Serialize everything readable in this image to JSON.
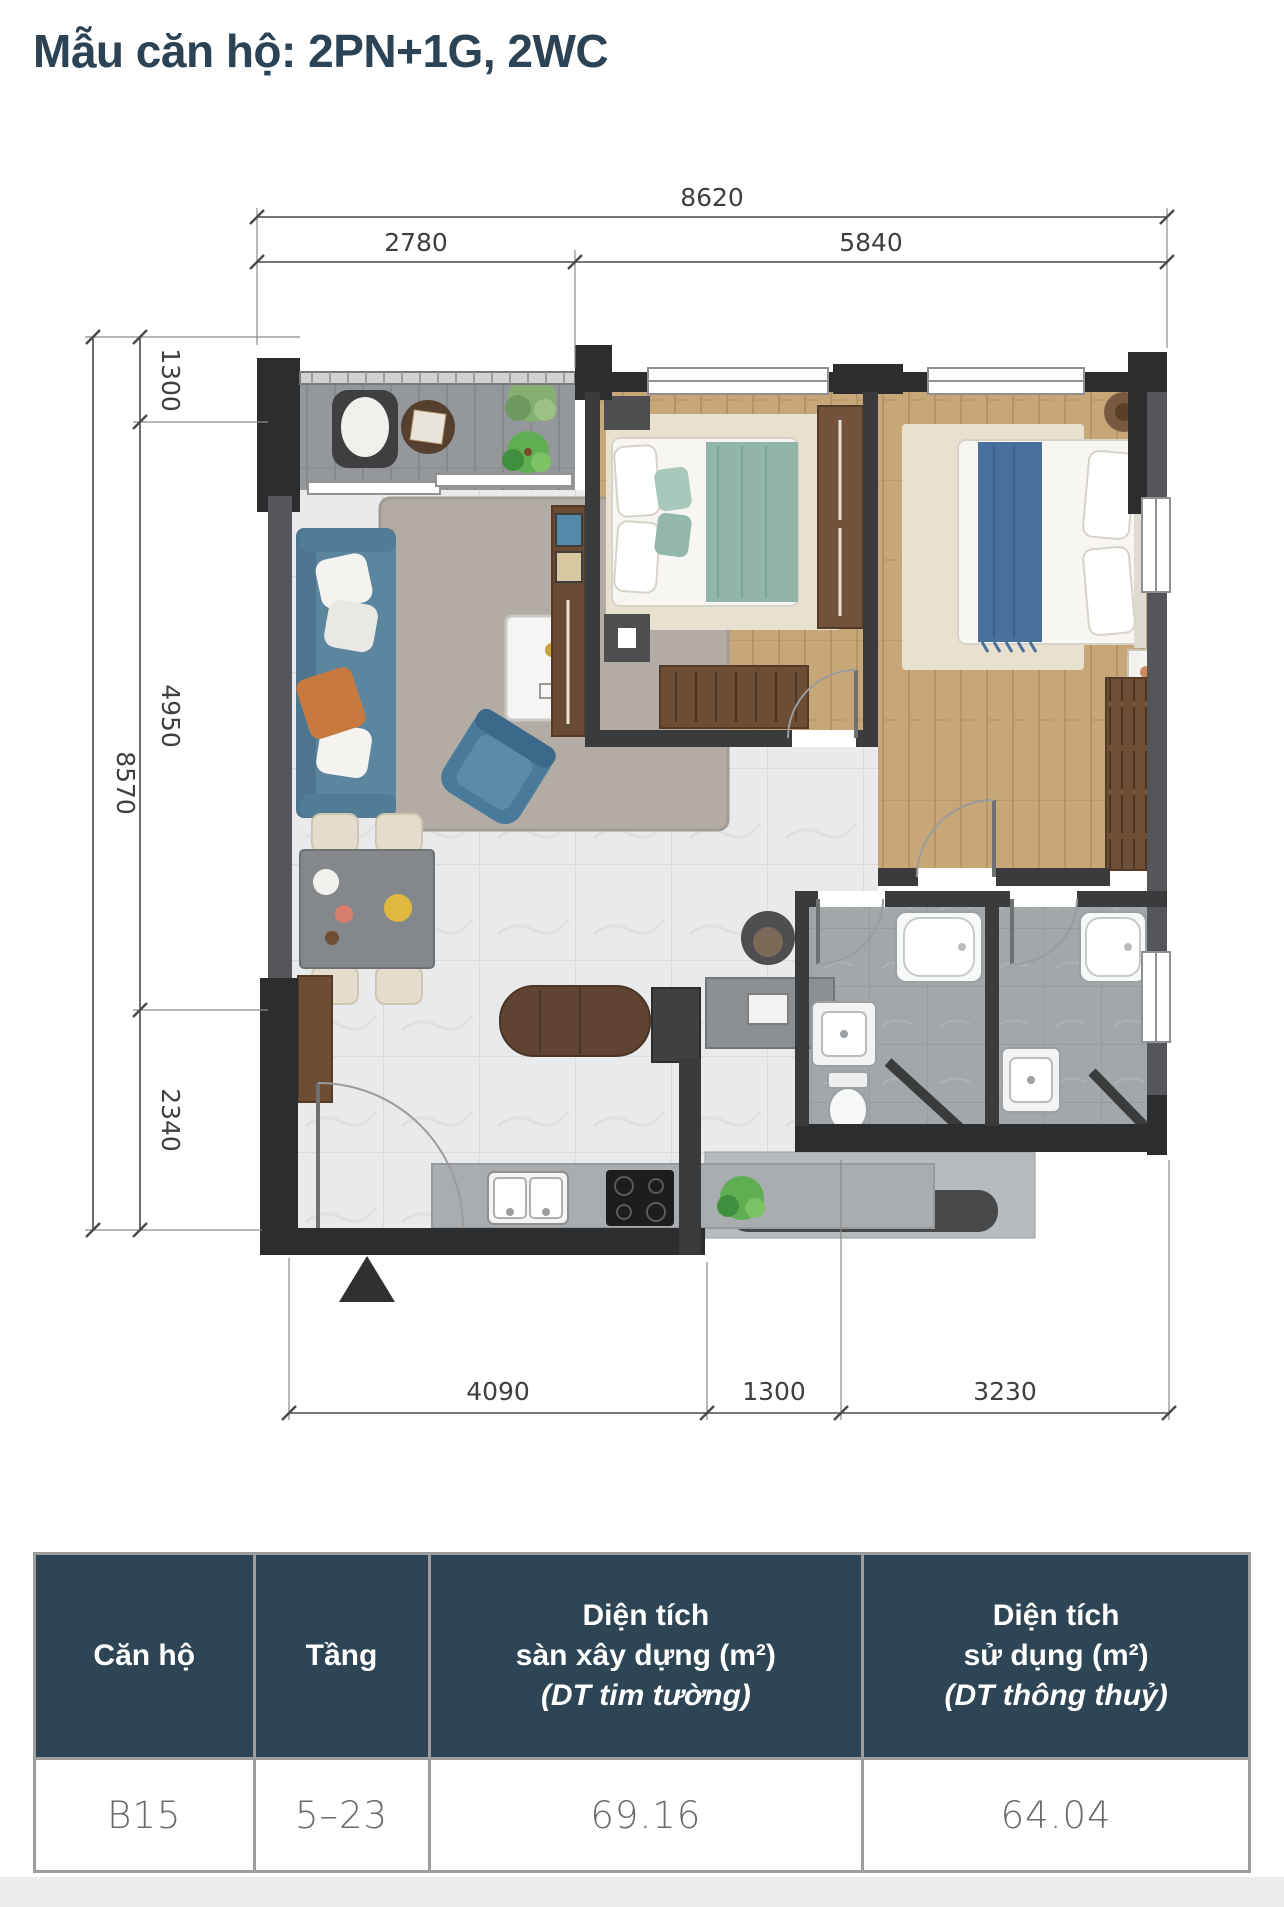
{
  "page": {
    "title": "Mẫu căn hộ: 2PN+1G, 2WC",
    "accent_color": "#2c4355",
    "table_header_color": "#2d4555"
  },
  "floor_plan": {
    "dimensions_mm": {
      "top_total": "8620",
      "top_segments": [
        "2780",
        "5840"
      ],
      "left_total": "8570",
      "left_segments": [
        "1300",
        "4950",
        "2340"
      ],
      "bottom_segments": [
        "4090",
        "1300",
        "3230"
      ]
    }
  },
  "table": {
    "columns": [
      {
        "title": "Căn hộ"
      },
      {
        "title": "Tầng"
      },
      {
        "title": "Diện tích",
        "subtitle": "sàn xây dựng (m²)",
        "note": "(DT tim tường)"
      },
      {
        "title": "Diện tích",
        "subtitle": "sử dụng (m²)",
        "note": "(DT thông thuỷ)"
      }
    ],
    "rows": [
      {
        "can_ho": "B15",
        "tang": "5–23",
        "dt_xay_dung": "69.16",
        "dt_su_dung": "64.04"
      }
    ]
  }
}
